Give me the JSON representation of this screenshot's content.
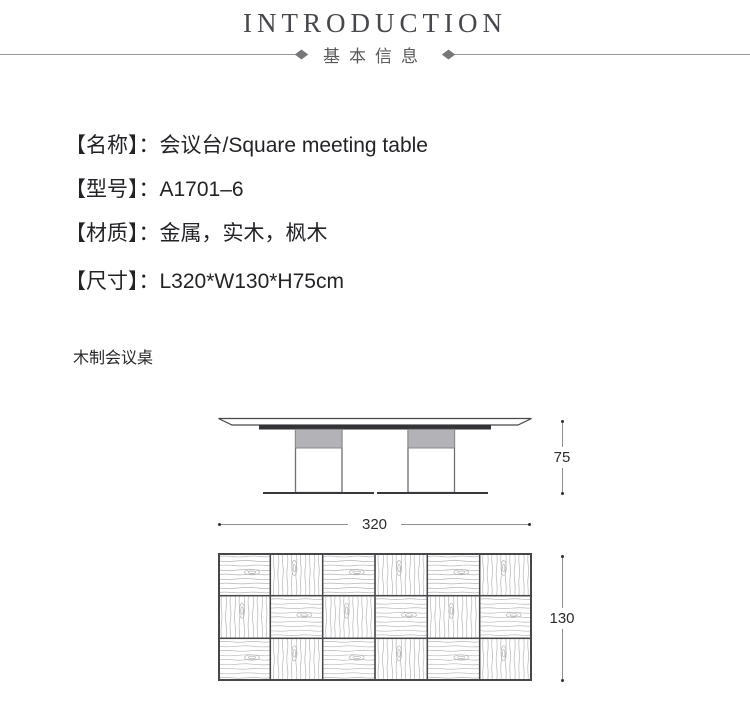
{
  "header": {
    "title": "INTRODUCTION",
    "subtitle": "基本信息"
  },
  "info": {
    "items": [
      {
        "text": "【名称】：会议台/Square meeting table"
      },
      {
        "text": "【型号】：A1701–6"
      },
      {
        "text": "【材质】：金属，实木，枫木"
      },
      {
        "text": "【尺寸】：L320*W130*H75cm"
      }
    ]
  },
  "section_caption": "木制会议桌",
  "drawing": {
    "side_view": {
      "height_label": "75"
    },
    "front_width_label": "320",
    "top_view": {
      "depth_label": "130",
      "rows": 3,
      "cols": 6,
      "pattern": [
        [
          "h",
          "v",
          "h",
          "v",
          "h",
          "v"
        ],
        [
          "v",
          "h",
          "v",
          "h",
          "v",
          "h"
        ],
        [
          "h",
          "v",
          "h",
          "v",
          "h",
          "v"
        ]
      ]
    }
  },
  "colors": {
    "title_text": "#47474d",
    "subtitle_text": "#5a5858",
    "body_text": "#222326",
    "rule_gray": "#97979b",
    "dim_line": "#8f8f93",
    "drawing_outline": "#47474b",
    "drawing_dark_bar": "#333338",
    "leg_band_gray": "#b3b3b7",
    "wood_grain": "#b6b6b6"
  }
}
